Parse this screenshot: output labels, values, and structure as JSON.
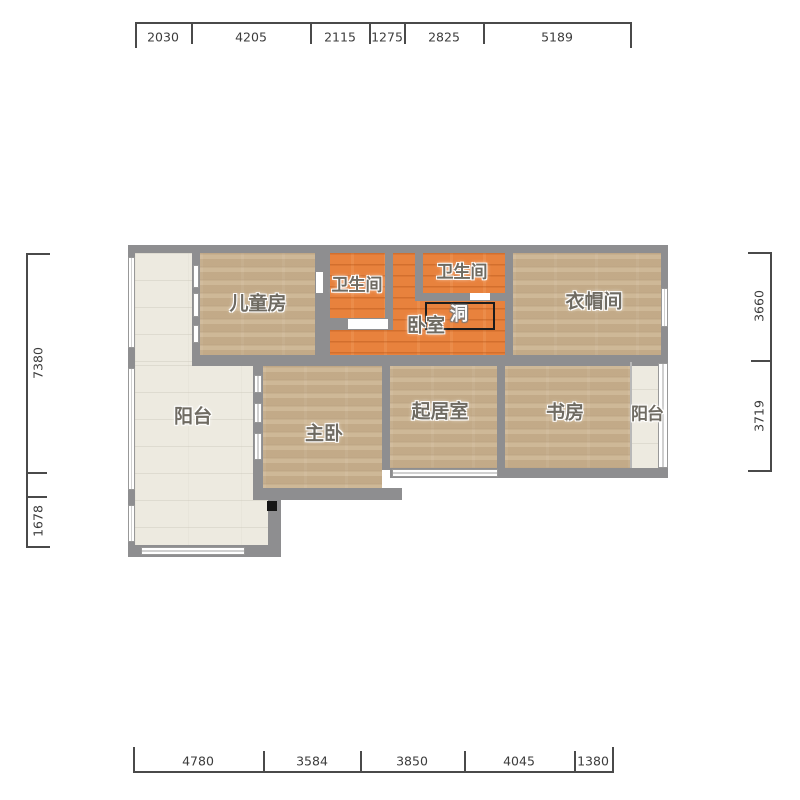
{
  "title": "apartment-floor-plan",
  "rooms": {
    "children": {
      "label": "儿童房"
    },
    "bath1": {
      "label": "卫生间"
    },
    "bath2": {
      "label": "卫生间"
    },
    "bedroom": {
      "label": "卧室"
    },
    "hole": {
      "label": "洞"
    },
    "cloakroom": {
      "label": "衣帽间"
    },
    "balcony_left": {
      "label": "阳台"
    },
    "master": {
      "label": "主卧"
    },
    "living": {
      "label": "起居室"
    },
    "study": {
      "label": "书房"
    },
    "balcony_right": {
      "label": "阳台"
    }
  },
  "dims": {
    "top": [
      "2030",
      "4205",
      "2115",
      "1275",
      "2825",
      "5189"
    ],
    "bottom": [
      "4780",
      "3584",
      "3850",
      "4045",
      "1380"
    ],
    "left": [
      "7380",
      "1678"
    ],
    "right": [
      "3660",
      "3719"
    ]
  },
  "colors": {
    "wall": "#8e8e90",
    "floor_wood": "#c9b18e",
    "floor_orange": "#e8823d",
    "floor_balcony": "#edeae0",
    "dimension_text": "#3c3c3c",
    "hole_outline": "#1c1c1c"
  }
}
